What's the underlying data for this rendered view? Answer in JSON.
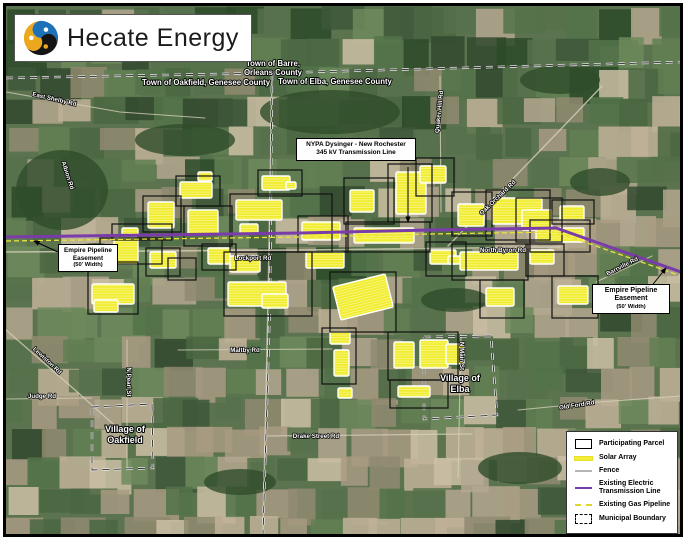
{
  "logo": {
    "name": "Hecate Energy"
  },
  "callouts": {
    "nypa": {
      "line1": "NYPA Dysinger - New Rochester",
      "line2": "345 kV Transmission Line"
    },
    "empire_left": {
      "title": "Empire Pipeline Easement",
      "note": "(50' Width)"
    },
    "empire_right": {
      "title": "Empire Pipeline Easement",
      "note": "(50' Width)"
    }
  },
  "legend": {
    "items": [
      {
        "label": "Participating Parcel",
        "symbol": "parcel-outline"
      },
      {
        "label": "Solar Array",
        "symbol": "solar-line"
      },
      {
        "label": "Fence",
        "symbol": "fence-line"
      },
      {
        "label": "Existing Electric Transmission Line",
        "symbol": "electric-line"
      },
      {
        "label": "Existing Gas Pipeline",
        "symbol": "gas-dashed-line"
      },
      {
        "label": "Municipal Boundary",
        "symbol": "municipal-dashed-box"
      }
    ]
  },
  "map": {
    "colors": {
      "base": "#5c7350",
      "forest": "#2f4c2b",
      "road": "#d6cfba",
      "transmission": "#7a3ca8",
      "gas": "#e8e33c",
      "solar": "#f1ed2e",
      "parcel_outline": "#111111"
    },
    "palette": {
      "greens": [
        "#55714a",
        "#617f52",
        "#4a6742",
        "#6d8a5c",
        "#52734a"
      ],
      "darks": [
        "#31492e",
        "#3d5738",
        "#2c4a28"
      ],
      "tans": [
        "#b3a78f",
        "#c0b299",
        "#a89b82",
        "#8f8a70",
        "#cbbfa4"
      ]
    },
    "forest_patches": [
      [
        62,
        190,
        46,
        40
      ],
      [
        330,
        112,
        70,
        22
      ],
      [
        185,
        140,
        50,
        16
      ],
      [
        520,
        468,
        42,
        16
      ],
      [
        240,
        482,
        36,
        13
      ],
      [
        600,
        182,
        30,
        14
      ],
      [
        95,
        255,
        28,
        12
      ],
      [
        455,
        300,
        34,
        12
      ],
      [
        560,
        80,
        40,
        14
      ]
    ],
    "roads": [
      {
        "pts": [
          [
            6,
            252
          ],
          [
            300,
            250
          ],
          [
            560,
            247
          ]
        ],
        "w": 1.6
      },
      {
        "pts": [
          [
            272,
            76
          ],
          [
            268,
            300
          ],
          [
            263,
            534
          ]
        ],
        "w": 1.4
      },
      {
        "pts": [
          [
            127,
            340
          ],
          [
            127,
            470
          ]
        ],
        "w": 1.1
      },
      {
        "pts": [
          [
            461,
            335
          ],
          [
            458,
            478
          ]
        ],
        "w": 1.1
      },
      {
        "pts": [
          [
            440,
            76
          ],
          [
            441,
            212
          ]
        ],
        "w": 1.1
      },
      {
        "pts": [
          [
            448,
            246
          ],
          [
            560,
            130
          ],
          [
            602,
            86
          ]
        ],
        "w": 1.4
      },
      {
        "pts": [
          [
            6,
            92
          ],
          [
            120,
            112
          ],
          [
            205,
            118
          ]
        ],
        "w": 1.1
      },
      {
        "pts": [
          [
            6,
            330
          ],
          [
            75,
            390
          ],
          [
            122,
            432
          ]
        ],
        "w": 1.3
      },
      {
        "pts": [
          [
            6,
            399
          ],
          [
            92,
            398
          ]
        ],
        "w": 1.1
      },
      {
        "pts": [
          [
            178,
            350
          ],
          [
            332,
            349
          ]
        ],
        "w": 1.1
      },
      {
        "pts": [
          [
            268,
            436
          ],
          [
            472,
            434
          ]
        ],
        "w": 1.3
      },
      {
        "pts": [
          [
            518,
            410
          ],
          [
            600,
            402
          ],
          [
            681,
            396
          ]
        ],
        "w": 1.1
      },
      {
        "pts": [
          [
            596,
            282
          ],
          [
            652,
            256
          ]
        ],
        "w": 1.1
      }
    ],
    "boundaries": [
      {
        "name": "county-line",
        "pts": [
          [
            6,
            78
          ],
          [
            273,
            73
          ],
          [
            681,
            62
          ]
        ]
      },
      {
        "name": "town-line",
        "pts": [
          [
            272,
            74
          ],
          [
            270,
            300
          ],
          [
            263,
            534
          ]
        ]
      },
      {
        "name": "village-oakfield",
        "pts": [
          [
            92,
            407
          ],
          [
            152,
            404
          ],
          [
            153,
            468
          ],
          [
            92,
            470
          ],
          [
            92,
            407
          ]
        ]
      },
      {
        "name": "village-elba",
        "pts": [
          [
            424,
            337
          ],
          [
            491,
            336
          ],
          [
            497,
            415
          ],
          [
            424,
            419
          ],
          [
            424,
            337
          ]
        ]
      }
    ],
    "transmission_line": {
      "color": "#7a3ca8",
      "pts": [
        [
          6,
          237
        ],
        [
          150,
          235
        ],
        [
          300,
          233
        ],
        [
          430,
          230
        ],
        [
          556,
          228
        ],
        [
          681,
          272
        ]
      ]
    },
    "gas_pipeline": {
      "color": "#e8e33c",
      "pts": [
        [
          6,
          241
        ],
        [
          150,
          239
        ],
        [
          300,
          237
        ],
        [
          430,
          234
        ],
        [
          556,
          232
        ],
        [
          681,
          276
        ]
      ]
    },
    "parcels": [
      [
        88,
        262,
        50,
        52
      ],
      [
        100,
        238,
        62,
        26
      ],
      [
        112,
        224,
        60,
        16
      ],
      [
        143,
        196,
        38,
        36
      ],
      [
        146,
        248,
        34,
        28
      ],
      [
        168,
        258,
        28,
        22
      ],
      [
        176,
        176,
        44,
        30
      ],
      [
        184,
        206,
        48,
        40
      ],
      [
        202,
        244,
        34,
        26
      ],
      [
        230,
        194,
        102,
        58
      ],
      [
        224,
        252,
        88,
        64
      ],
      [
        258,
        170,
        44,
        26
      ],
      [
        298,
        216,
        50,
        36
      ],
      [
        330,
        272,
        66,
        60
      ],
      [
        322,
        328,
        34,
        56
      ],
      [
        344,
        178,
        50,
        46
      ],
      [
        388,
        164,
        44,
        58
      ],
      [
        416,
        158,
        38,
        38
      ],
      [
        346,
        222,
        84,
        30
      ],
      [
        426,
        242,
        40,
        34
      ],
      [
        452,
        192,
        40,
        44
      ],
      [
        486,
        190,
        64,
        50
      ],
      [
        516,
        198,
        46,
        44
      ],
      [
        530,
        220,
        60,
        32
      ],
      [
        552,
        200,
        42,
        24
      ],
      [
        452,
        244,
        76,
        36
      ],
      [
        526,
        244,
        38,
        32
      ],
      [
        552,
        276,
        46,
        42
      ],
      [
        480,
        280,
        44,
        38
      ],
      [
        388,
        332,
        70,
        48
      ],
      [
        390,
        380,
        58,
        28
      ]
    ],
    "solar_arrays": [
      [
        92,
        284,
        42,
        20
      ],
      [
        94,
        300,
        24,
        12
      ],
      [
        114,
        238,
        24,
        26
      ],
      [
        122,
        228,
        16,
        8
      ],
      [
        148,
        202,
        26,
        26
      ],
      [
        150,
        252,
        26,
        16
      ],
      [
        180,
        182,
        32,
        16
      ],
      [
        198,
        172,
        14,
        9
      ],
      [
        188,
        210,
        30,
        24
      ],
      [
        208,
        248,
        22,
        16
      ],
      [
        236,
        200,
        46,
        20
      ],
      [
        240,
        224,
        18,
        10
      ],
      [
        262,
        176,
        28,
        14
      ],
      [
        286,
        182,
        10,
        7
      ],
      [
        230,
        256,
        30,
        16
      ],
      [
        228,
        282,
        58,
        24
      ],
      [
        262,
        294,
        26,
        14
      ],
      [
        302,
        222,
        38,
        18
      ],
      [
        306,
        252,
        38,
        16
      ],
      [
        336,
        280,
        54,
        34,
        -14
      ],
      [
        330,
        332,
        20,
        12
      ],
      [
        334,
        350,
        15,
        26
      ],
      [
        338,
        388,
        14,
        10
      ],
      [
        350,
        190,
        24,
        22
      ],
      [
        354,
        228,
        60,
        15
      ],
      [
        396,
        172,
        30,
        42
      ],
      [
        420,
        166,
        26,
        17
      ],
      [
        430,
        250,
        26,
        14
      ],
      [
        448,
        256,
        12,
        8
      ],
      [
        458,
        204,
        26,
        22
      ],
      [
        492,
        198,
        50,
        26
      ],
      [
        522,
        210,
        30,
        20
      ],
      [
        536,
        228,
        48,
        14
      ],
      [
        560,
        206,
        24,
        14
      ],
      [
        460,
        252,
        58,
        18
      ],
      [
        530,
        250,
        24,
        14
      ],
      [
        486,
        288,
        28,
        18
      ],
      [
        558,
        286,
        30,
        18
      ],
      [
        394,
        342,
        20,
        26
      ],
      [
        420,
        340,
        28,
        28
      ],
      [
        446,
        344,
        18,
        20
      ],
      [
        398,
        386,
        32,
        11
      ]
    ],
    "labels": [
      {
        "t": "Town of Barre,",
        "x": 273,
        "y": 66,
        "r": 0,
        "s": "town"
      },
      {
        "t": "Orleans County",
        "x": 273,
        "y": 75,
        "r": 0,
        "s": "town"
      },
      {
        "t": "Town of Oakfield, Genesee County",
        "x": 206,
        "y": 85,
        "r": 0,
        "s": "town"
      },
      {
        "t": "Town of Elba, Genesee County",
        "x": 335,
        "y": 84,
        "r": 0,
        "s": "town"
      },
      {
        "t": "Village of",
        "x": 125,
        "y": 432,
        "r": 0,
        "s": "village"
      },
      {
        "t": "Oakfield",
        "x": 125,
        "y": 443,
        "r": 0,
        "s": "village"
      },
      {
        "t": "Village of",
        "x": 460,
        "y": 381,
        "r": 0,
        "s": "village"
      },
      {
        "t": "Elba",
        "x": 460,
        "y": 392,
        "r": 0,
        "s": "village"
      },
      {
        "t": "East Shelby Rd",
        "x": 54,
        "y": 101,
        "r": 13,
        "s": "road"
      },
      {
        "t": "Albion Rd",
        "x": 66,
        "y": 176,
        "r": 72,
        "s": "road"
      },
      {
        "t": "Lewiston Rd",
        "x": 46,
        "y": 362,
        "r": 43,
        "s": "road"
      },
      {
        "t": "Judge Rd",
        "x": 42,
        "y": 398,
        "r": 0,
        "s": "road"
      },
      {
        "t": "N Pearl St",
        "x": 127,
        "y": 382,
        "r": 90,
        "s": "road"
      },
      {
        "t": "Maltby Rd",
        "x": 245,
        "y": 352,
        "r": 0,
        "s": "road"
      },
      {
        "t": "Lockport Rd",
        "x": 253,
        "y": 260,
        "r": 0,
        "s": "road"
      },
      {
        "t": "Drake Street Rd",
        "x": 316,
        "y": 438,
        "r": 0,
        "s": "road"
      },
      {
        "t": "N Main St",
        "x": 460,
        "y": 356,
        "r": 90,
        "s": "road"
      },
      {
        "t": "Old Ford Rd",
        "x": 577,
        "y": 407,
        "r": -9,
        "s": "road"
      },
      {
        "t": "Quaker Hill Rd",
        "x": 441,
        "y": 112,
        "r": -84,
        "s": "road"
      },
      {
        "t": "Oak Orchard Rd",
        "x": 499,
        "y": 199,
        "r": -44,
        "s": "road"
      },
      {
        "t": "North Byron Rd",
        "x": 503,
        "y": 252,
        "r": 0,
        "s": "road"
      },
      {
        "t": "Barrville Rd",
        "x": 623,
        "y": 268,
        "r": -27,
        "s": "road"
      }
    ],
    "arrows": [
      {
        "name": "nypa-leader",
        "pts": [
          [
            408,
            167
          ],
          [
            408,
            222
          ]
        ]
      },
      {
        "name": "empire-left",
        "pts": [
          [
            58,
            252
          ],
          [
            34,
            241
          ]
        ]
      },
      {
        "name": "empire-right",
        "pts": [
          [
            650,
            288
          ],
          [
            666,
            268
          ]
        ]
      }
    ]
  }
}
